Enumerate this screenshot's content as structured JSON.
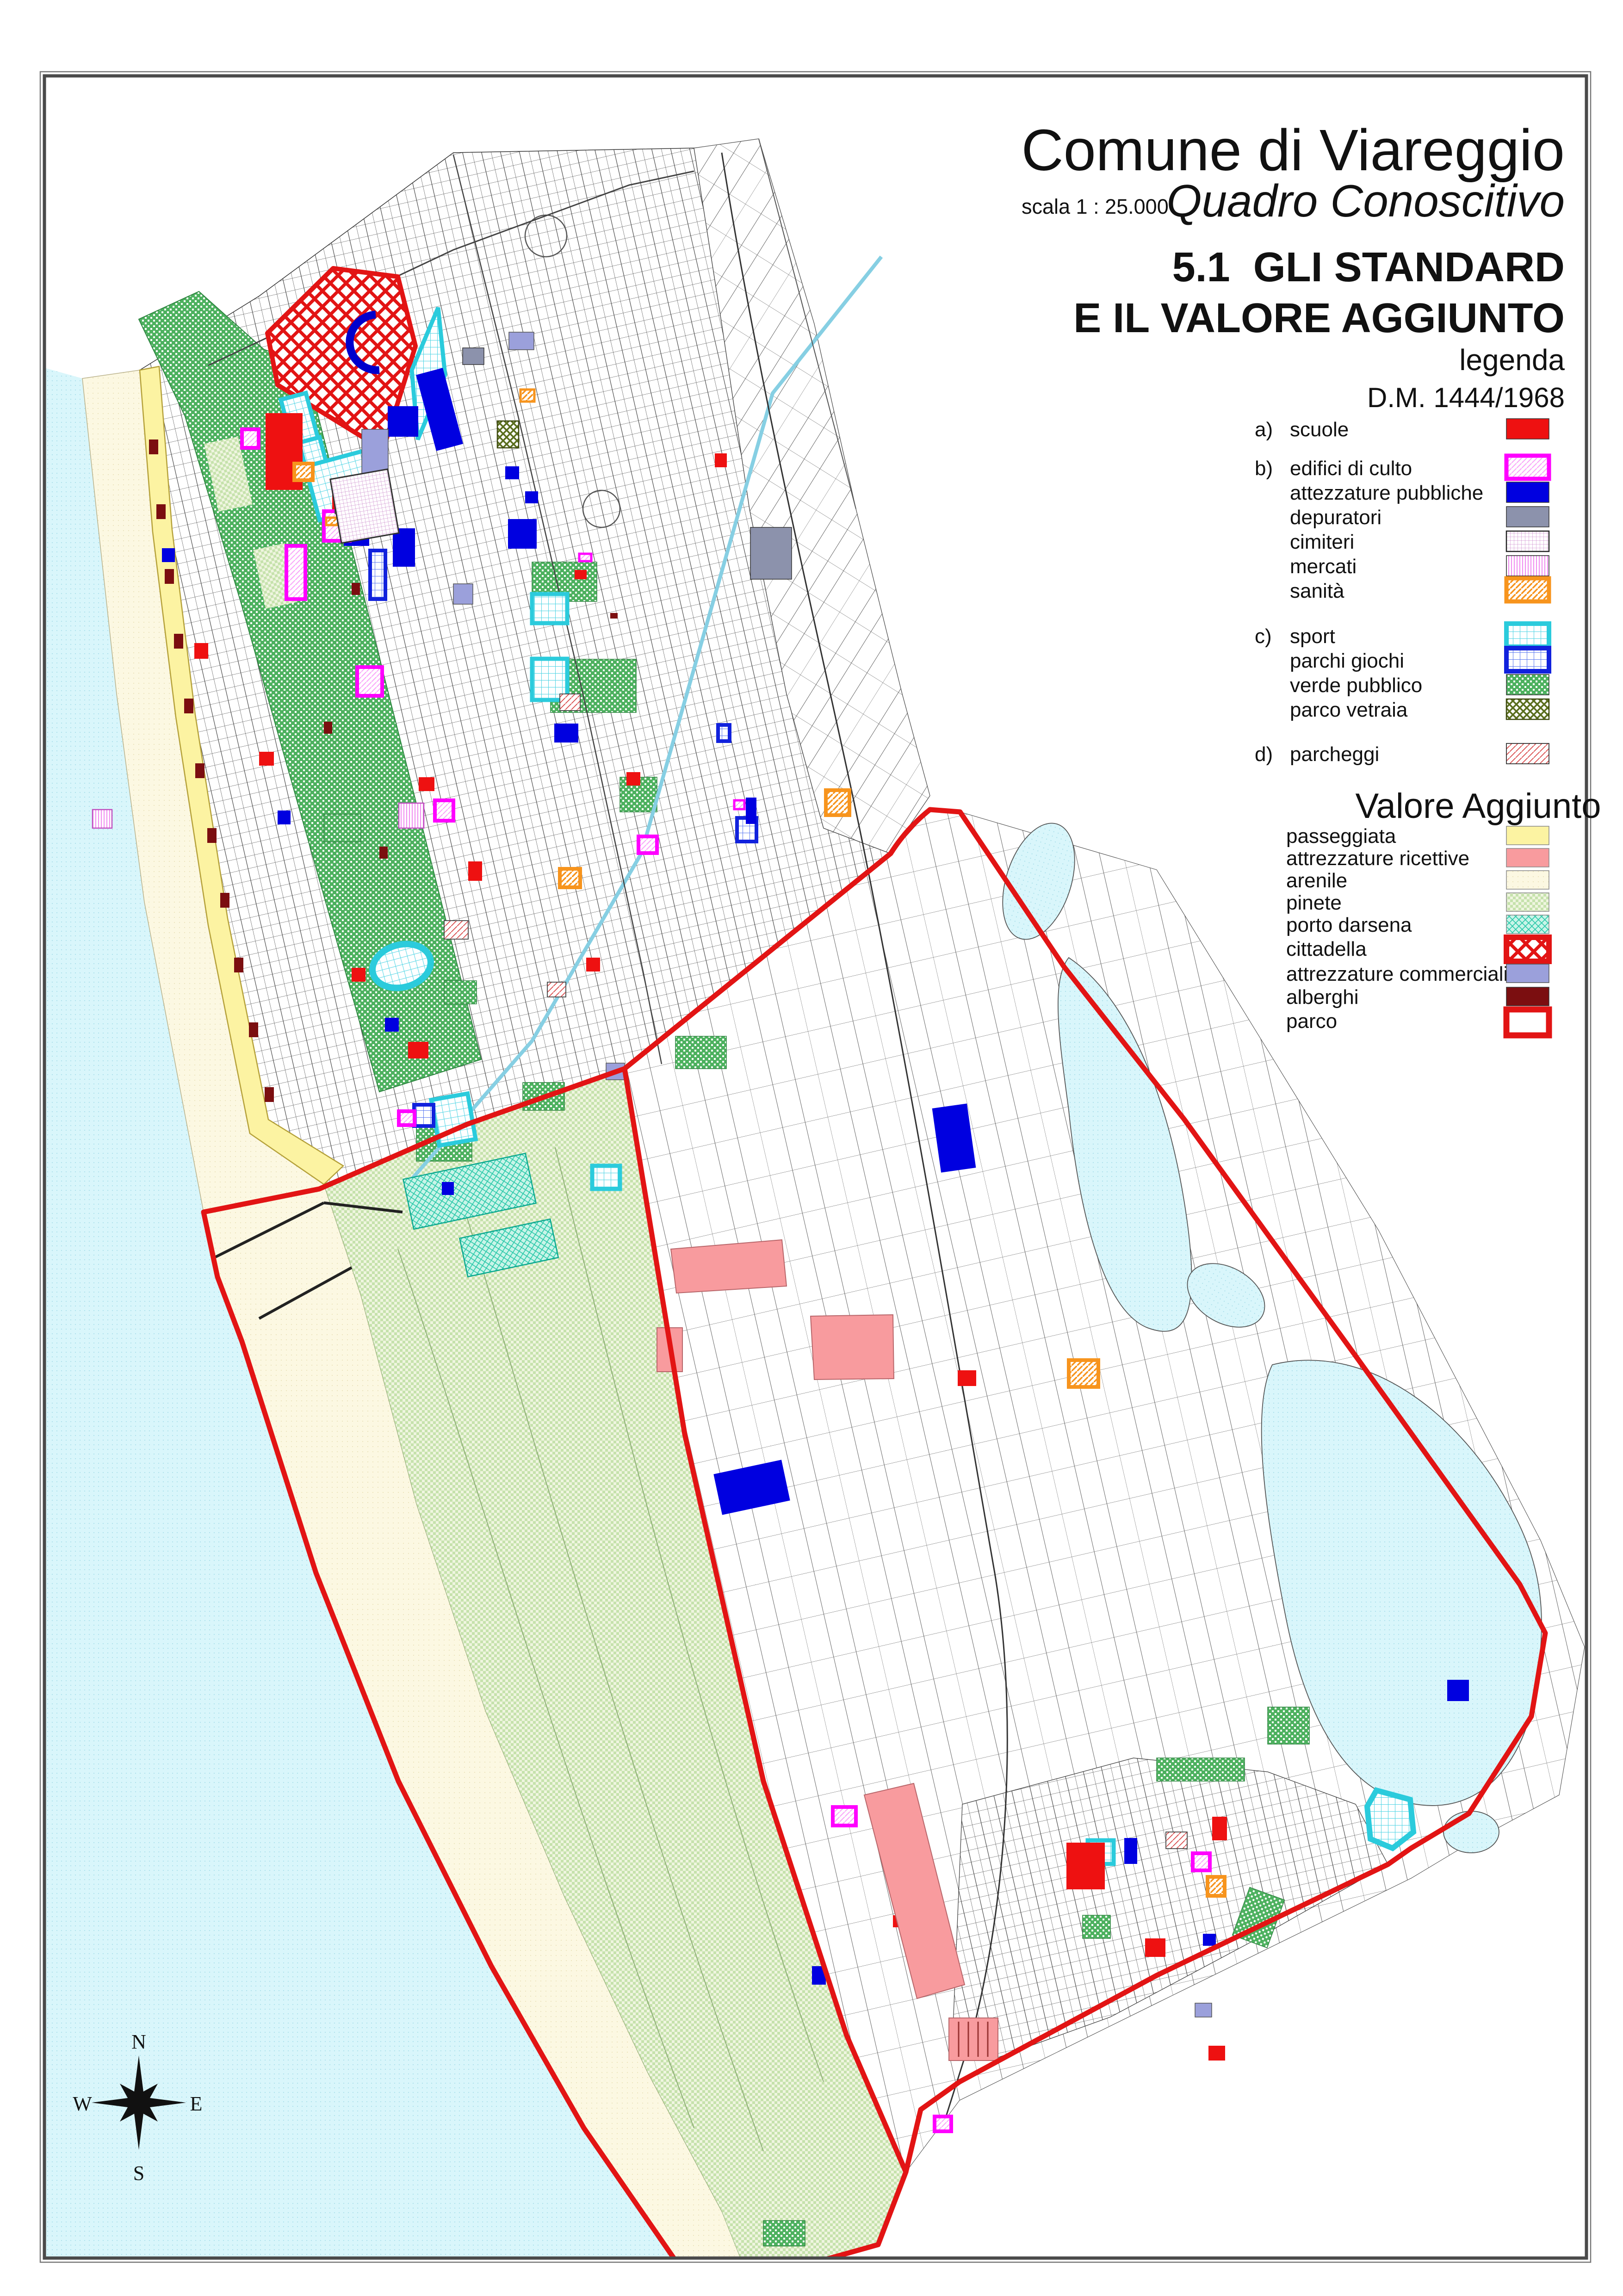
{
  "title_block": {
    "title": "Comune di Viareggio",
    "scale_label": "scala 1 : 25.000",
    "subtitle": "Quadro Conoscitivo",
    "heading_line1": "5.1  GLI STANDARD",
    "heading_line2": "E IL VALORE AGGIUNTO",
    "legend_label": "legenda",
    "decree": "D.M. 1444/1968"
  },
  "legend": {
    "decree_items": [
      {
        "prefix": "a)",
        "label": "scuole",
        "swatch": "solid-red"
      },
      {
        "prefix": "b)",
        "label": "edifici di culto",
        "swatch": "magenta-border-hatch"
      },
      {
        "prefix": "",
        "label": "attezzature pubbliche",
        "swatch": "solid-blue"
      },
      {
        "prefix": "",
        "label": "depuratori",
        "swatch": "solid-gray"
      },
      {
        "prefix": "",
        "label": "cimiteri",
        "swatch": "magenta-grid"
      },
      {
        "prefix": "",
        "label": "mercati",
        "swatch": "magenta-vlines"
      },
      {
        "prefix": "",
        "label": "sanità",
        "swatch": "orange-border-hatch"
      },
      {
        "prefix": "c)",
        "label": "sport",
        "swatch": "cyan-border-grid"
      },
      {
        "prefix": "",
        "label": "parchi giochi",
        "swatch": "blue-border-grid"
      },
      {
        "prefix": "",
        "label": "verde pubblico",
        "swatch": "green-dots"
      },
      {
        "prefix": "",
        "label": "parco vetraia",
        "swatch": "olive-crosshatch"
      },
      {
        "prefix": "d)",
        "label": "parcheggi",
        "swatch": "red-diagonal-hatch"
      }
    ],
    "valore_aggiunto": {
      "heading": "Valore Aggiunto",
      "items": [
        {
          "label": "passeggiata",
          "swatch": "solid-pale-yellow"
        },
        {
          "label": "attrezzature ricettive",
          "swatch": "solid-pink"
        },
        {
          "label": "arenile",
          "swatch": "cream-dots"
        },
        {
          "label": "pinete",
          "swatch": "light-green-checker"
        },
        {
          "label": "porto darsena",
          "swatch": "teal-crosshatch"
        },
        {
          "label": "cittadella",
          "swatch": "red-border-crosshatch"
        },
        {
          "label": "attrezzature commerciali",
          "swatch": "solid-periwinkle"
        },
        {
          "label": "alberghi",
          "swatch": "solid-maroon"
        },
        {
          "label": "parco",
          "swatch": "red-border-white"
        }
      ]
    }
  },
  "compass": {
    "north": "N",
    "south": "S",
    "east": "E",
    "west": "W"
  },
  "palette": {
    "scuole": "#EE1111",
    "edifici_di_culto": "#FF00FF",
    "attezzature_pubbliche": "#0000E0",
    "depuratori": "#8C92AC",
    "sanita": "#F7941D",
    "sport": "#2BCBDC",
    "parchi_giochi": "#1122DD",
    "verde_pubblico": "#4DB15F",
    "parco_vetraia": "#5A6E1E",
    "parcheggi": "#D84848",
    "passeggiata": "#FCF3A2",
    "attrezzature_ricettive": "#F89B9E",
    "arenile": "#FCF8E2",
    "pinete": "#C6E2AC",
    "porto_darsena": "#28C8A8",
    "cittadella": "#E21414",
    "attrezzature_commerciali": "#9BA0DB",
    "alberghi": "#7B0E10",
    "parco_border": "#E21414",
    "sea": "#D9F6FB"
  }
}
